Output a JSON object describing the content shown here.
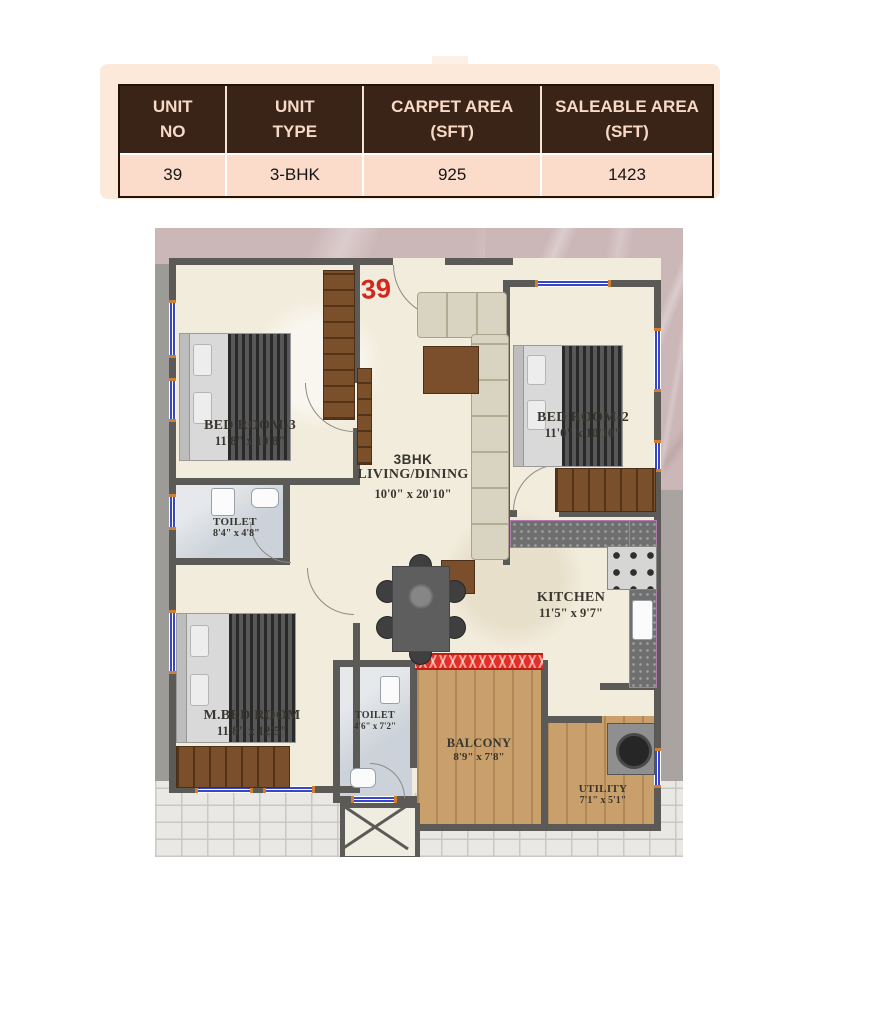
{
  "unit_table": {
    "headers": [
      {
        "line1": "UNIT",
        "line2": "NO"
      },
      {
        "line1": "UNIT",
        "line2": "TYPE"
      },
      {
        "line1": "CARPET AREA",
        "line2": "(SFT)"
      },
      {
        "line1": "SALEABLE AREA",
        "line2": "(SFT)"
      }
    ],
    "row": {
      "unit_no": "39",
      "unit_type": "3-BHK",
      "carpet_area": "925",
      "saleable_area": "1423"
    },
    "colors": {
      "header_bg": "#3A2317",
      "header_text": "#F7D9C5",
      "row_bg": "#FBDCCA",
      "panel_bg": "#FCE9DA"
    }
  },
  "floor_plan": {
    "unit_number": "39",
    "rooms": [
      {
        "id": "bedroom3",
        "name": "BED ROOM-3",
        "dims": "11'8\" x 10'8\""
      },
      {
        "id": "bedroom2",
        "name": "BED ROOM-2",
        "dims": "11'0\" x 10'10\""
      },
      {
        "id": "living",
        "type_label": "3BHK",
        "name": "LIVING/DINING",
        "dims": "10'0\" x 20'10\""
      },
      {
        "id": "kitchen",
        "name": "KITCHEN",
        "dims": "11'5\" x 9'7\""
      },
      {
        "id": "mbedroom",
        "name": "M.BED ROOM",
        "dims": "11'8\" x 12'5\""
      },
      {
        "id": "toilet1",
        "name": "TOILET",
        "dims": "8'4\" x 4'8\""
      },
      {
        "id": "toilet2",
        "name": "TOILET",
        "dims": "4'6\" x 7'2\""
      },
      {
        "id": "balcony",
        "name": "BALCONY",
        "dims": "8'9\" x 7'8\""
      },
      {
        "id": "utility",
        "name": "UTILITY",
        "dims": "7'1\" x 5'1\""
      }
    ],
    "colors": {
      "wall": "#5C5A57",
      "floor": "#F2ECDC",
      "toilet_floor": "#CCD2D9",
      "wood_floor": "#C9A06C",
      "marble_bg": "#CCB7B8",
      "unit_number_red": "#D3261D",
      "window_blue": "#3946C6",
      "window_frame_orange": "#CF7F2E"
    }
  }
}
